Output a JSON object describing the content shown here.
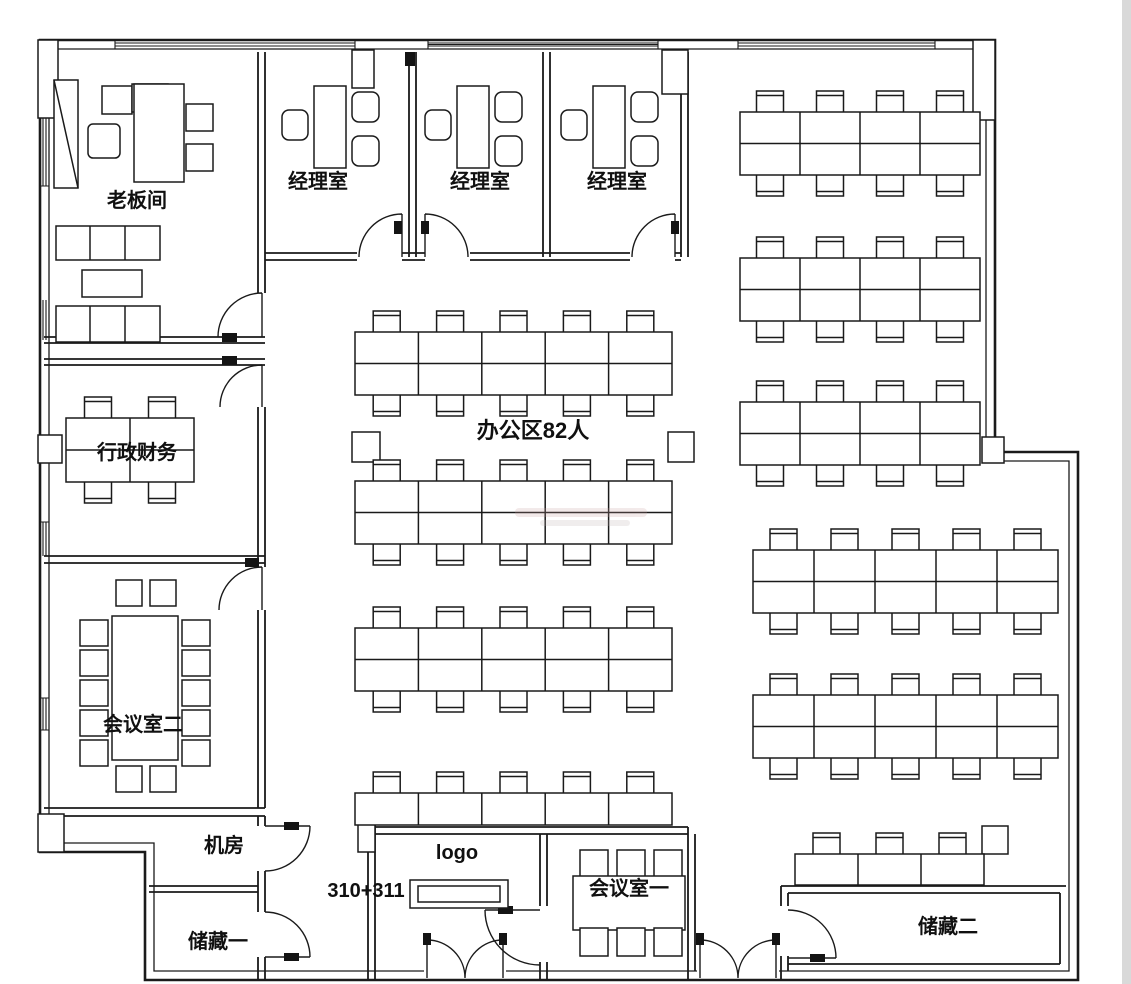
{
  "floor_plan": {
    "rooms": {
      "boss_room": "老板间",
      "manager_room_1": "经理室",
      "manager_room_2": "经理室",
      "manager_room_3": "经理室",
      "admin_finance": "行政财务",
      "meeting_room_2": "会议室二",
      "machine_room": "机房",
      "storage_1": "储藏一",
      "meeting_room_1": "会议室一",
      "storage_2": "储藏二"
    },
    "annotations": {
      "open_office": "办公区82人",
      "logo": "logo",
      "unit_number": "310+311"
    },
    "colors": {
      "line": "#1a1a1a",
      "background": "#ffffff"
    }
  }
}
